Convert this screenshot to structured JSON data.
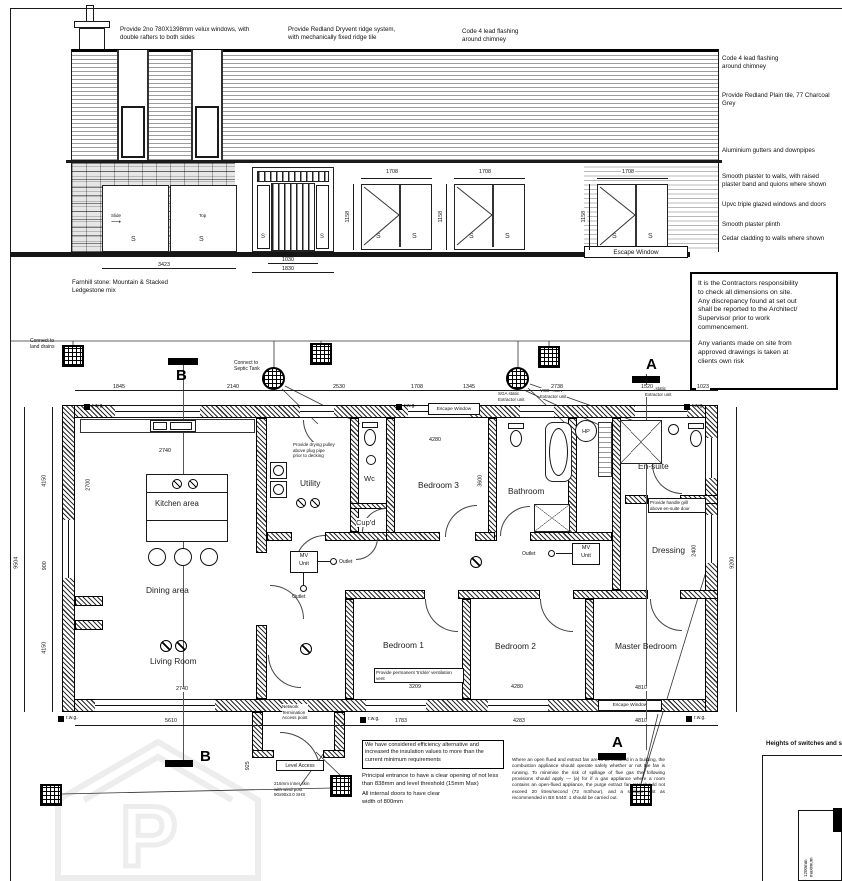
{
  "drawing": {
    "elevation": {
      "note_velux": "Provide 2no 780X1398mm velux windows, with\ndouble rafters to both sides",
      "note_ridge": "Provide Redland Dryvent ridge system,\nwith mechanically fixed ridge tile",
      "note_lead_top": "Code 4 lead flashing\naround chimney",
      "note_lead_right": "Code 4 lead flashing\naround chimney",
      "note_tiles": "Provide Redland Plain tile, 77 Charcoal\nGrey",
      "note_gutters": "Aluminium gutters and downpipes",
      "note_plaster": "Smooth plaster to walls, with raised\nplaster band and quions where shown",
      "note_upvc": "Upvc triple glazed windows and doors",
      "note_plinth": "Smooth plaster plinth",
      "note_cedar": "Cedar cladding to walls where shown",
      "note_stone": "Farnhill stone: Mountain & Stacked\nLedgestone mix",
      "escape_window": "Escape Window",
      "sash": "S",
      "slide": "Slide",
      "top_hung": "Top",
      "dims": {
        "win_w": "1708",
        "win_h": "1158",
        "door_inner": "1030",
        "door_outer": "1830",
        "stone_windows": "3423"
      }
    },
    "contractor_note": {
      "para1": "It is the Contractors responsibility\nto check all dimensions on site.\nAny discrepancy found at set out\nshall be reported to the Architect/\nSupervisor prior to work\ncommencement.",
      "para2": "Any variants made on site from\napproved drawings is taken at\nclients own risk"
    },
    "plan": {
      "rooms": {
        "kitchen": "Kitchen area",
        "dining": "Dining area",
        "living": "Living Room",
        "utility": "Utility",
        "wc": "Wc",
        "cupd": "Cup'd",
        "bedroom3": "Bedroom 3",
        "bathroom": "Bathroom",
        "ensuite": "En-suite",
        "dressing": "Dressing",
        "bedroom1": "Bedroom 1",
        "bedroom2": "Bedroom 2",
        "master": "Master Bedroom"
      },
      "labels": {
        "connect_drains": "Connect to\nland drains",
        "connect_septic": "Connect to\nSeptic Tank",
        "escape_window": "Escape Window",
        "mv_unit": "MV\nUnit",
        "outlet": "Outlet",
        "rwg": "r.w.g.",
        "hp": "HP",
        "network": "Network\nTermination\nAccess point",
        "level_access": "Level Access",
        "wind_post": "215mm inner skin\nwith wind post\n90x90x3.0 SHS",
        "trickle": "Provide permanent 'trickle' ventilation\nvent",
        "drying": "Provide drying pulley\nabove plug pipe\nprior to decking",
        "handrail": "Provide handle grill\nabove en-suite door",
        "extract_sga": "SGA static\nExtractor unit",
        "extract_vcd": "VCD +MEV\nExtractor unit",
        "section_a": "A",
        "section_b": "B"
      },
      "dims": {
        "top": [
          "1845",
          "2140",
          "2530",
          "1708",
          "1345",
          "2738",
          "1520",
          "1023"
        ],
        "bottom": [
          "5610",
          "1783",
          "4283",
          "4810"
        ],
        "left": [
          "4150",
          "900",
          "4150"
        ],
        "left_total": "9504",
        "right_total": "9200",
        "kitchen_w": "2740",
        "living_w": "2740",
        "bed3_w": "4280",
        "bed1_w": "3209",
        "bed2_w": "4280",
        "master_w": "4810",
        "bed3_h": "3600",
        "dressing_h": "2400",
        "kitchen_h": "2700",
        "porch": "925"
      }
    },
    "notes_bottom": {
      "efficiency": "We have considered efficiency alternative and\nincreased the insulation values to more than the\ncurrent minimum requirements",
      "entrance": "Principal entrance to have a clear opening of not less\nthan 838mm and level threshold (15mm Max)",
      "doors": "All internal doors to have clear\nwidth of 800mm",
      "open_flue": "Where an open flued and extract fan are to be installed in a building, the combustion appliance should operate safely whether or not the fan is running. To minimise the risk of spillage of flue gas the following provisions should apply — (a) for if a gas appliance where a room contains an open-flued appliance, the purge extract fan rate should not exceed 20 litres/second (72 m3/hour), and a spillage test as recommended in BS 5440: 1 should be carried out.",
      "heights": "Heights of switches and sockets",
      "switch_dim": "1200mm\nmaximum"
    }
  }
}
